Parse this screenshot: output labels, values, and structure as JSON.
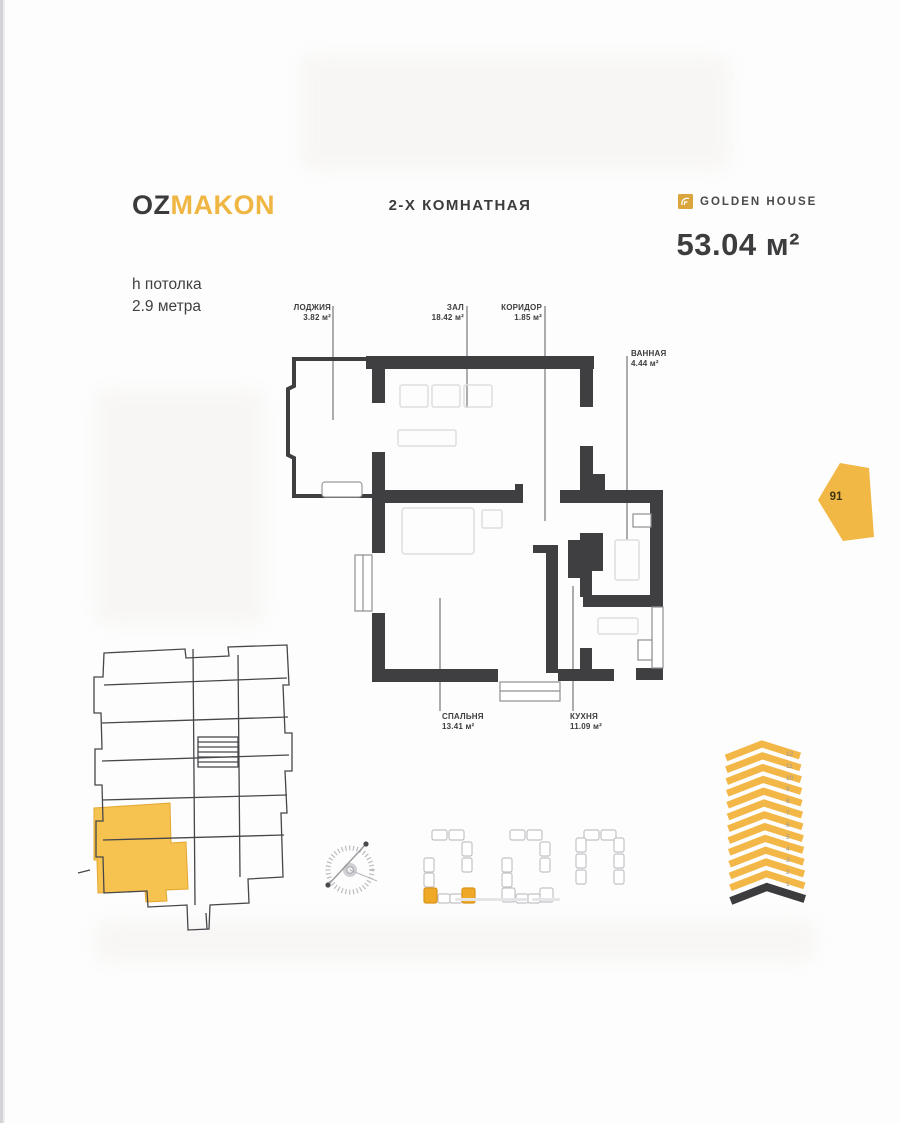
{
  "brand": {
    "part1": "OZ",
    "part2": "MAKON"
  },
  "header": {
    "title": "2-Х КОМНАТНАЯ",
    "partner": "GOLDEN HOUSE",
    "total_area": "53.04 м²",
    "ceiling_line1": "h потолка",
    "ceiling_line2": "2.9 метра"
  },
  "unit_badge": "91",
  "rooms": [
    {
      "name": "ЛОДЖИЯ",
      "area": "3.82 м²"
    },
    {
      "name": "ЗАЛ",
      "area": "18.42 м²"
    },
    {
      "name": "КОРИДОР",
      "area": "1.85 м²"
    },
    {
      "name": "ВАННАЯ",
      "area": "4.44 м²"
    },
    {
      "name": "СПАЛЬНЯ",
      "area": "13.41 м²"
    },
    {
      "name": "КУХНЯ",
      "area": "11.09 м²"
    }
  ],
  "tower": {
    "floors": [
      "12",
      "11",
      "10",
      "9",
      "8",
      "7",
      "6",
      "5",
      "4",
      "3",
      "2",
      "1"
    ]
  },
  "colors": {
    "accent": "#f0b643",
    "wall": "#3f3f41",
    "key_plan_highlight": "#f6c350",
    "site_block_highlight": "#f0a827"
  }
}
